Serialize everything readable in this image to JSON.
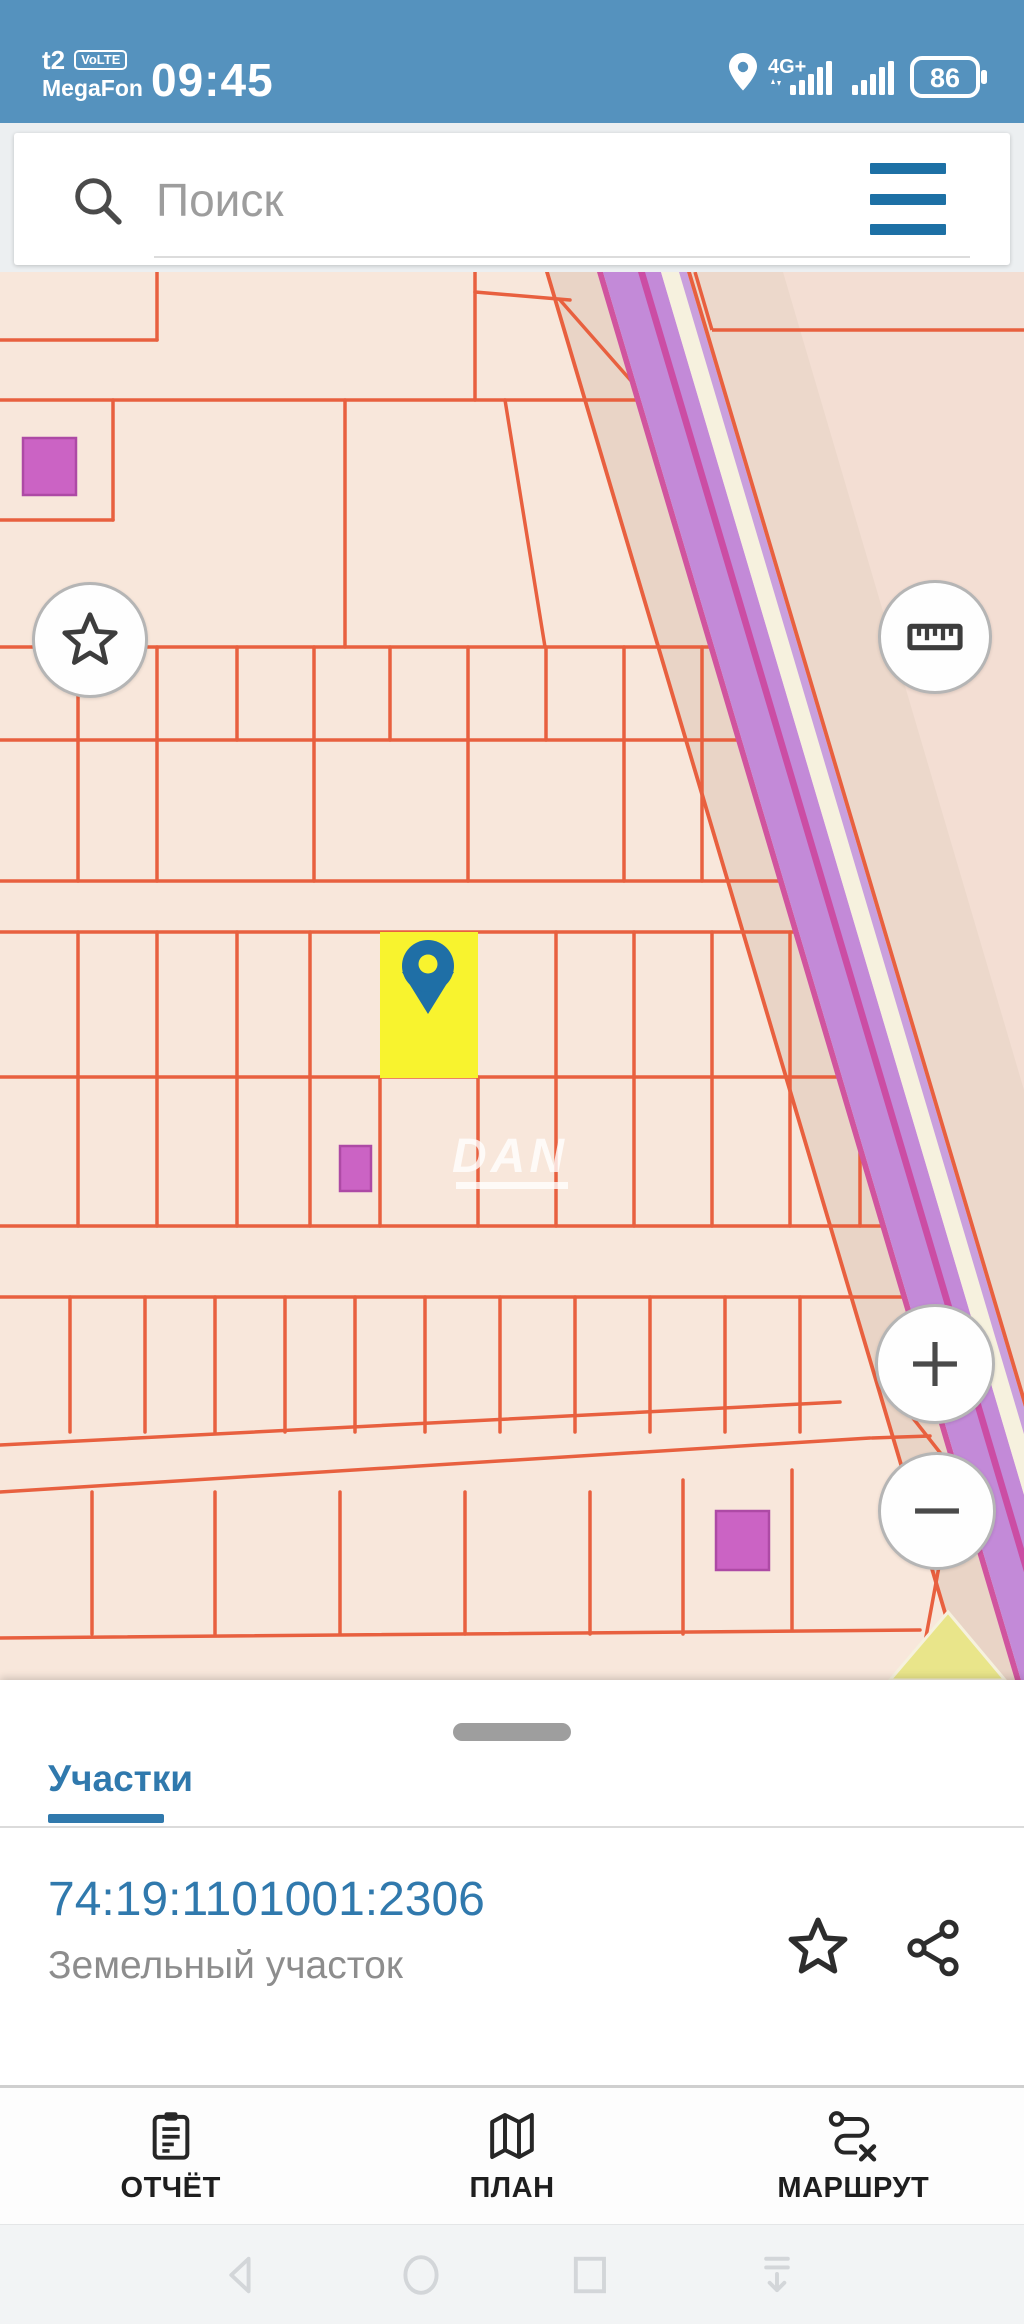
{
  "status_bar": {
    "carrier_badge": "t2",
    "volte_label": "VoLTE",
    "carrier_name": "MegaFon",
    "time": "09:45",
    "network": "4G+",
    "battery_percent": "86"
  },
  "search": {
    "placeholder": "Поиск"
  },
  "map": {
    "watermark": "DAN",
    "colors": {
      "left_bg": "#f8e7db",
      "right_bg": "#f3ded3",
      "right_band": "#ecd8cb",
      "shadow": "#e9d4c6",
      "line": "#e8603f",
      "purple": "#c38ad8",
      "magenta": "#cb4da4",
      "cream": "#f6f1de",
      "lilac": "#c9a0dd",
      "pink_edge": "#d0549f",
      "yellow": "#f8f32e",
      "pin": "#1f6fa6",
      "square_fill": "#cb63c4",
      "square_stroke": "#ad4aa5",
      "wedge": "#e9e58a",
      "watermark": "#ffffff"
    },
    "road": {
      "x_top": 601,
      "x_bottom": 1019,
      "y_top": 272,
      "y_bottom": 1680,
      "bands": [
        [
          -56,
          -52,
          "line"
        ],
        [
          -4,
          2,
          "pink_edge"
        ],
        [
          2,
          60,
          "purple"
        ],
        [
          37,
          44,
          "magenta"
        ],
        [
          60,
          78,
          "cream"
        ],
        [
          78,
          86,
          "lilac"
        ],
        [
          86,
          90,
          "line"
        ]
      ],
      "shadow_band": [
        -52,
        0
      ]
    },
    "grid_clip": "0,272 601,272 1019,1680 0,1680",
    "right_bg_pts": "689,272 1024,272 1024,1407",
    "right_band_pts": "689,272 783,272 1024,1090 1024,1407",
    "wedge_pts": "890,1680 1005,1680 948,1612",
    "h_lines": [
      [
        0,
        340,
        157,
        340
      ],
      [
        0,
        400,
        700,
        400
      ],
      [
        0,
        520,
        113,
        520
      ],
      [
        0,
        647,
        740,
        647
      ],
      [
        0,
        740,
        760,
        740
      ],
      [
        0,
        881,
        800,
        881
      ],
      [
        0,
        932,
        820,
        932
      ],
      [
        0,
        1077,
        860,
        1077
      ],
      [
        0,
        1226,
        900,
        1226
      ],
      [
        0,
        1297,
        920,
        1297
      ],
      [
        0,
        1445,
        840,
        1402
      ],
      [
        0,
        1492,
        870,
        1438
      ],
      [
        0,
        1638,
        920,
        1630
      ]
    ],
    "v_lines": [
      [
        157,
        272,
        340
      ],
      [
        475,
        272,
        400
      ],
      [
        113,
        400,
        520
      ],
      [
        345,
        400,
        647
      ],
      [
        78,
        647,
        740
      ],
      [
        157,
        647,
        740
      ],
      [
        237,
        647,
        740
      ],
      [
        314,
        647,
        740
      ],
      [
        390,
        647,
        740
      ],
      [
        468,
        647,
        740
      ],
      [
        546,
        647,
        740
      ],
      [
        624,
        647,
        740
      ],
      [
        702,
        647,
        740
      ],
      [
        78,
        740,
        881
      ],
      [
        157,
        740,
        881
      ],
      [
        314,
        740,
        881
      ],
      [
        468,
        740,
        881
      ],
      [
        624,
        740,
        881
      ],
      [
        702,
        740,
        881
      ],
      [
        78,
        932,
        1077
      ],
      [
        157,
        932,
        1077
      ],
      [
        237,
        932,
        1077
      ],
      [
        310,
        932,
        1077
      ],
      [
        556,
        932,
        1077
      ],
      [
        634,
        932,
        1077
      ],
      [
        712,
        932,
        1077
      ],
      [
        790,
        932,
        1077
      ],
      [
        78,
        1077,
        1226
      ],
      [
        157,
        1077,
        1226
      ],
      [
        237,
        1077,
        1226
      ],
      [
        310,
        1077,
        1226
      ],
      [
        380,
        1077,
        1226
      ],
      [
        478,
        1077,
        1226
      ],
      [
        556,
        1077,
        1226
      ],
      [
        634,
        1077,
        1226
      ],
      [
        712,
        1077,
        1226
      ],
      [
        790,
        1077,
        1226
      ],
      [
        860,
        1077,
        1226
      ],
      [
        70,
        1297,
        1432
      ],
      [
        145,
        1297,
        1432
      ],
      [
        215,
        1297,
        1432
      ],
      [
        285,
        1297,
        1432
      ],
      [
        355,
        1297,
        1432
      ],
      [
        425,
        1297,
        1432
      ],
      [
        500,
        1297,
        1432
      ],
      [
        575,
        1297,
        1432
      ],
      [
        650,
        1297,
        1432
      ],
      [
        725,
        1297,
        1432
      ],
      [
        800,
        1297,
        1432
      ],
      [
        92,
        1492,
        1634
      ],
      [
        215,
        1492,
        1634
      ],
      [
        340,
        1492,
        1634
      ],
      [
        465,
        1492,
        1634
      ],
      [
        590,
        1492,
        1634
      ],
      [
        683,
        1480,
        1634
      ],
      [
        792,
        1470,
        1630
      ]
    ],
    "segments_clipped": [
      [
        475,
        292,
        570,
        300
      ],
      [
        560,
        300,
        648,
        400
      ],
      [
        505,
        400,
        545,
        647
      ],
      [
        883,
        1380,
        960,
        1478
      ],
      [
        955,
        1480,
        918,
        1680
      ],
      [
        872,
        1438,
        930,
        1436
      ]
    ],
    "segments_right": [
      [
        695,
        272,
        712,
        330
      ],
      [
        712,
        330,
        1024,
        330
      ]
    ],
    "squares": [
      [
        23,
        438,
        53,
        57
      ],
      [
        340,
        1146,
        31,
        45
      ],
      [
        716,
        1511,
        53,
        59
      ]
    ],
    "selected_parcel": {
      "x": 380,
      "y": 932,
      "w": 98,
      "h": 146
    },
    "pin": {
      "cx": 428,
      "cy": 966,
      "r": 26,
      "tip_y": 1014,
      "hole_r": 9.5
    }
  },
  "sheet": {
    "tab": "Участки",
    "parcel_number": "74:19:1101001:2306",
    "parcel_type": "Земельный участок"
  },
  "bottom_nav": {
    "items": [
      {
        "id": "report",
        "label": "ОТЧЁТ"
      },
      {
        "id": "plan",
        "label": "ПЛАН"
      },
      {
        "id": "route",
        "label": "МАРШРУТ"
      }
    ]
  }
}
